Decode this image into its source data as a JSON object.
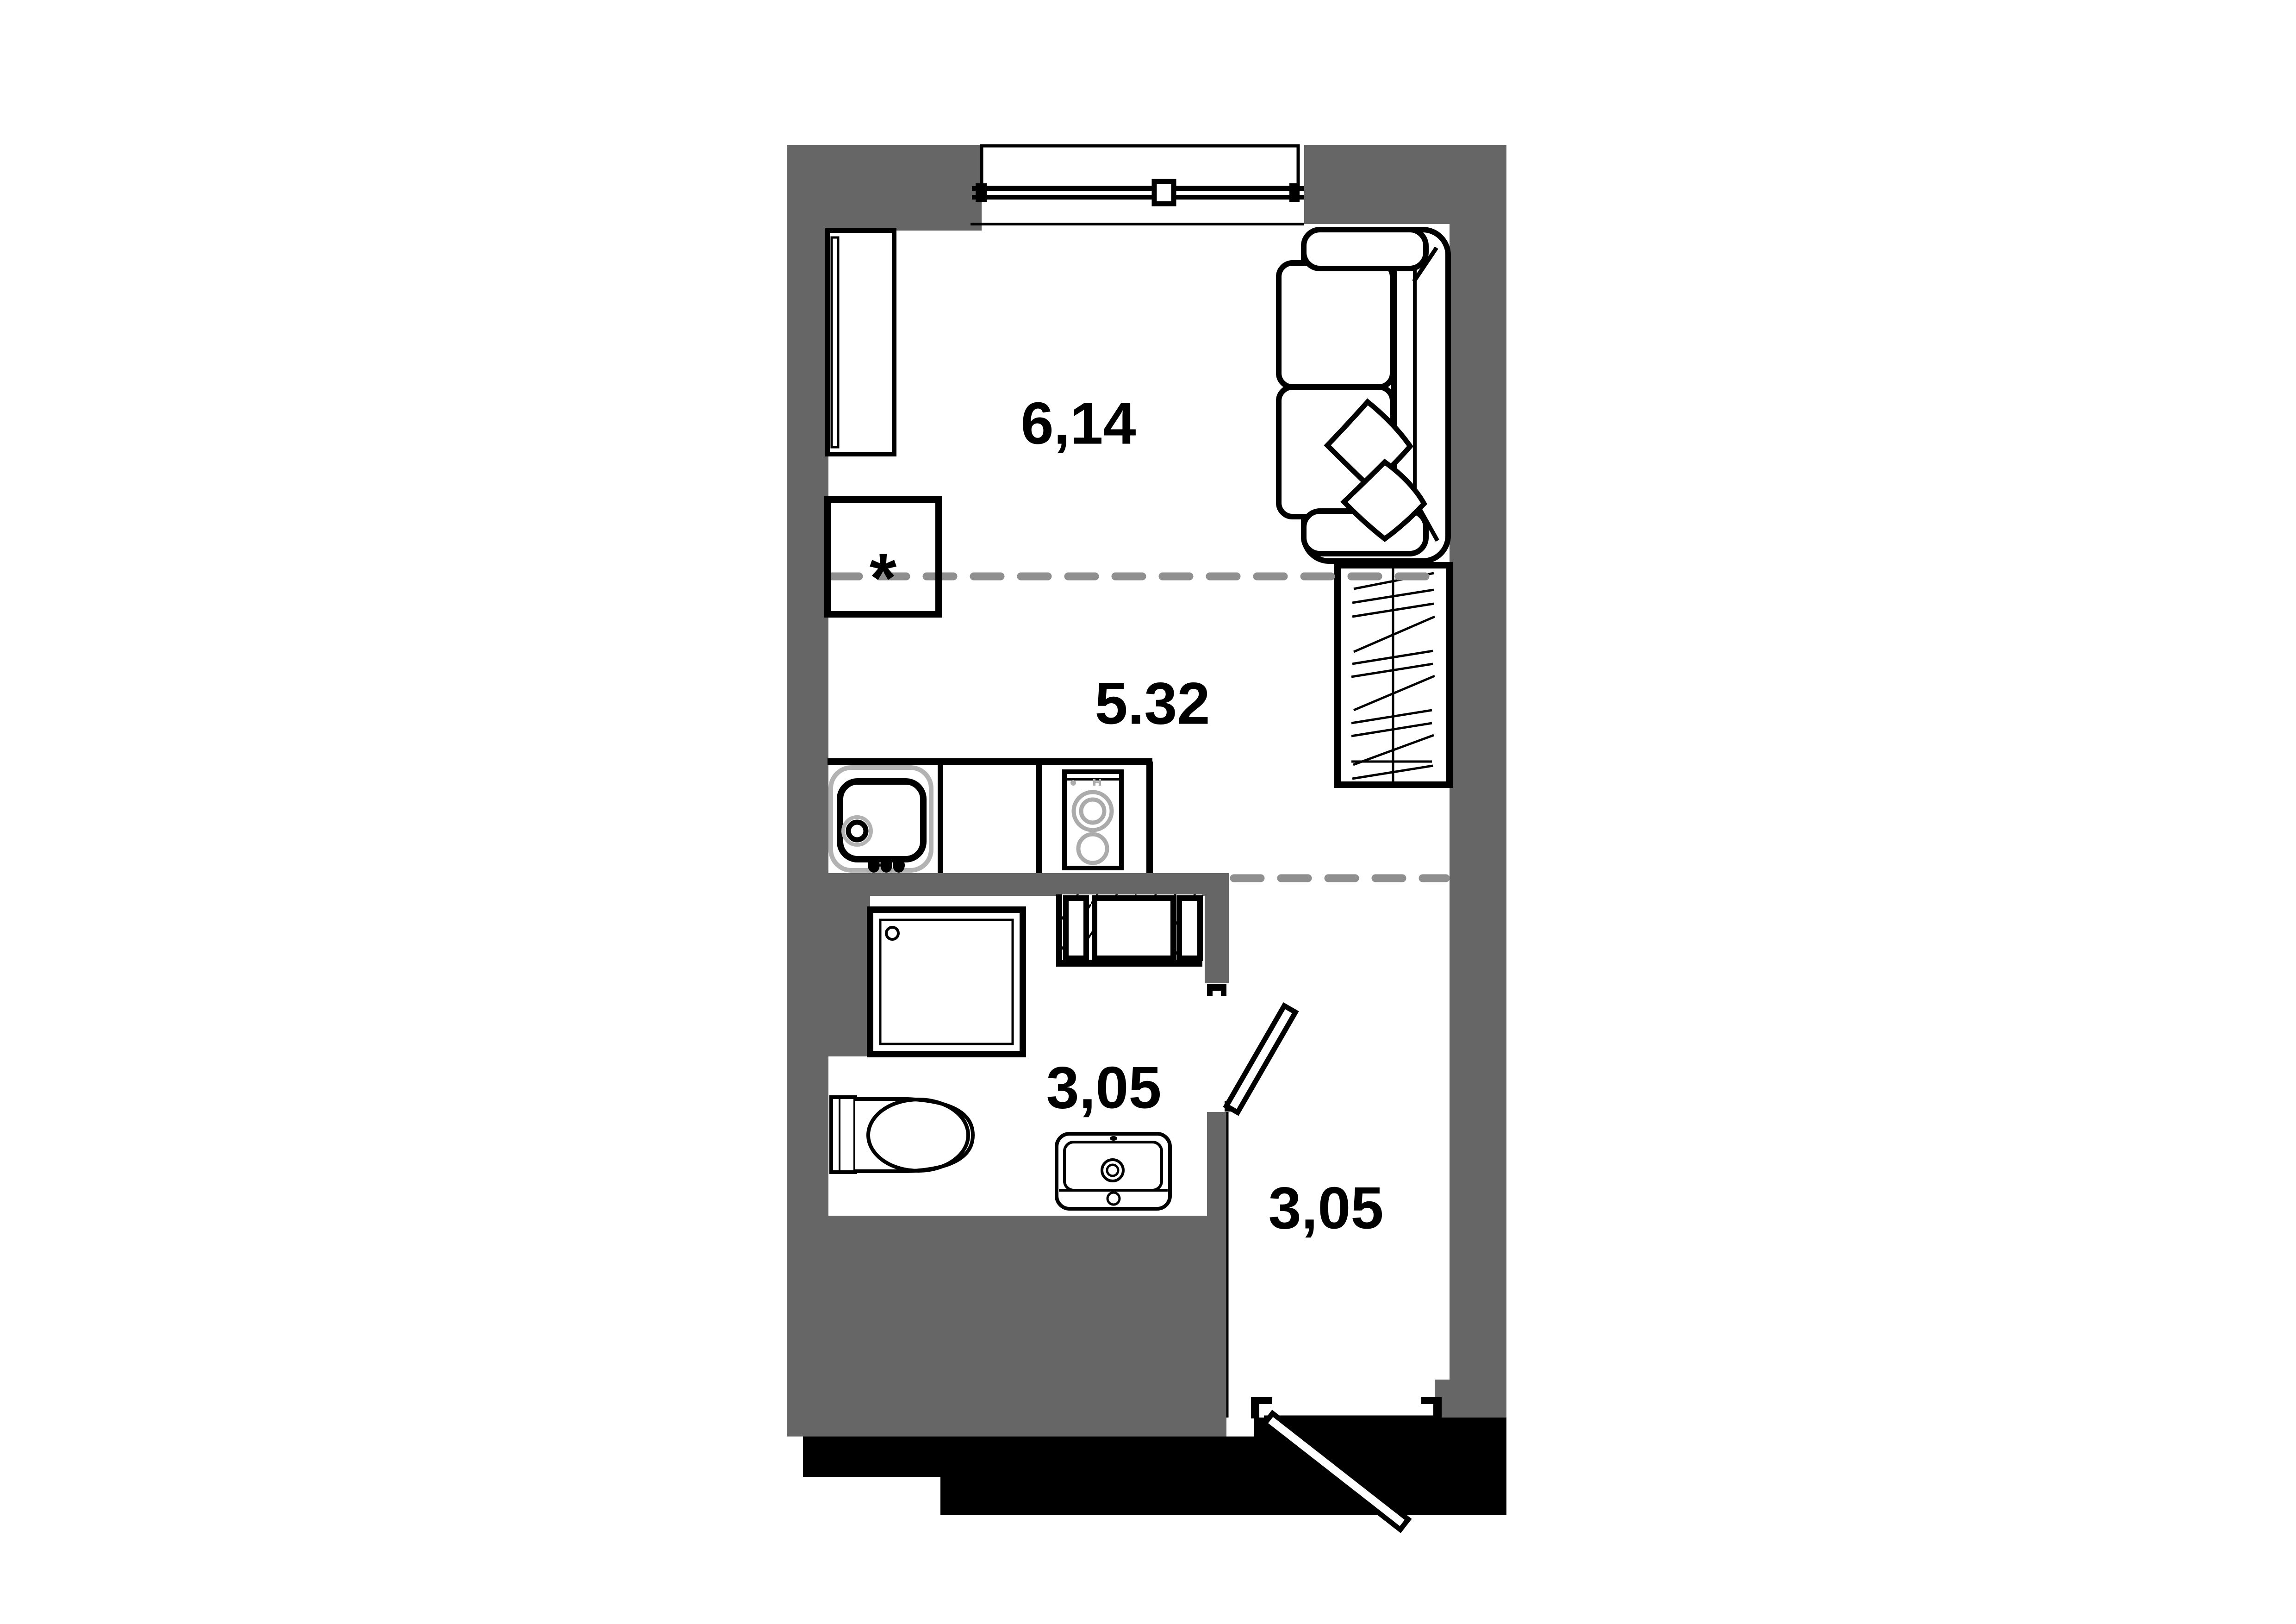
{
  "document": {
    "type": "apartment-floor-plan",
    "background": "#FFFFFF"
  },
  "colors": {
    "wall_fill": "#666666",
    "outline": "#000000",
    "zone_dash": "#8F8F8F",
    "fixture_gray": "#ABABAB",
    "sink_rim_gray": "#B3B3B3",
    "entry_mass": "#000000"
  },
  "rooms": {
    "living": {
      "area_label": "6,14"
    },
    "kitchen": {
      "area_label": "5.32"
    },
    "bathroom": {
      "area_label": "3,05"
    },
    "hallway": {
      "area_label": "3,05"
    }
  },
  "markers": {
    "kitchen_unit": "*"
  },
  "fixtures": [
    "wardrobe",
    "sofa",
    "bed",
    "kitchen-sink",
    "stove",
    "kitchen-counter",
    "vent-niche",
    "shower-cabin",
    "toilet",
    "vanity-sink",
    "bathroom-door",
    "entrance-door",
    "window"
  ]
}
